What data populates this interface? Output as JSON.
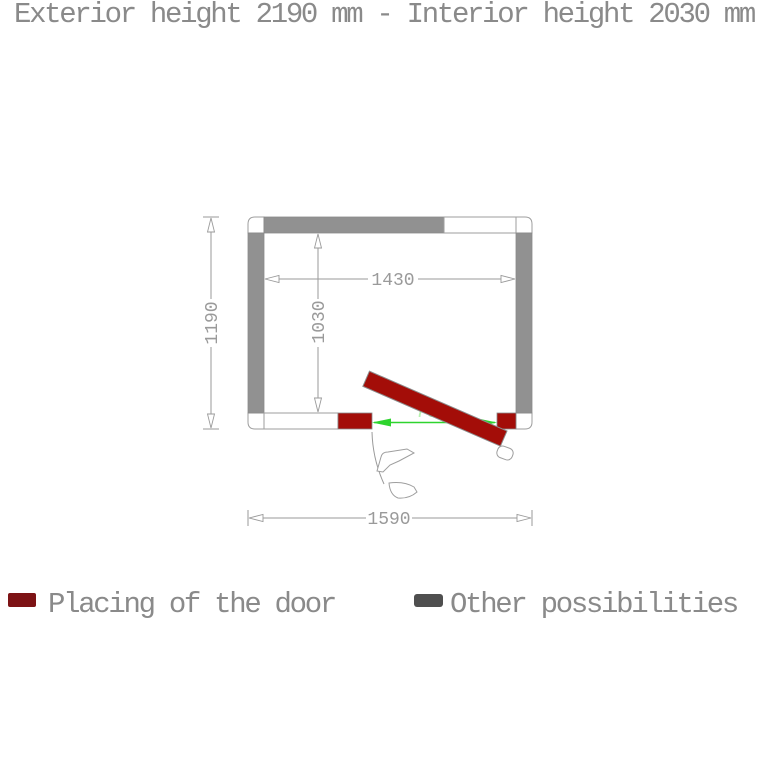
{
  "title": "Exterior height 2190 mm - Interior height 2030 mm",
  "diagram": {
    "dimensions": {
      "exterior_width": "1590",
      "exterior_height": "1190",
      "interior_width": "1430",
      "interior_height": "1030",
      "door_clearance": "700"
    },
    "colors": {
      "wall_gray": "#919191",
      "door_red": "#a30d08",
      "dimension_gray": "#9a9a9a",
      "door_dimension_green": "#2ed42e",
      "door_dimension_text_green": "#b5f2ae"
    }
  },
  "legend": {
    "door": {
      "label": "Placing of the door",
      "color": "#7d1315"
    },
    "other": {
      "label": "Other possibilities",
      "color": "#4f4f4f"
    }
  }
}
